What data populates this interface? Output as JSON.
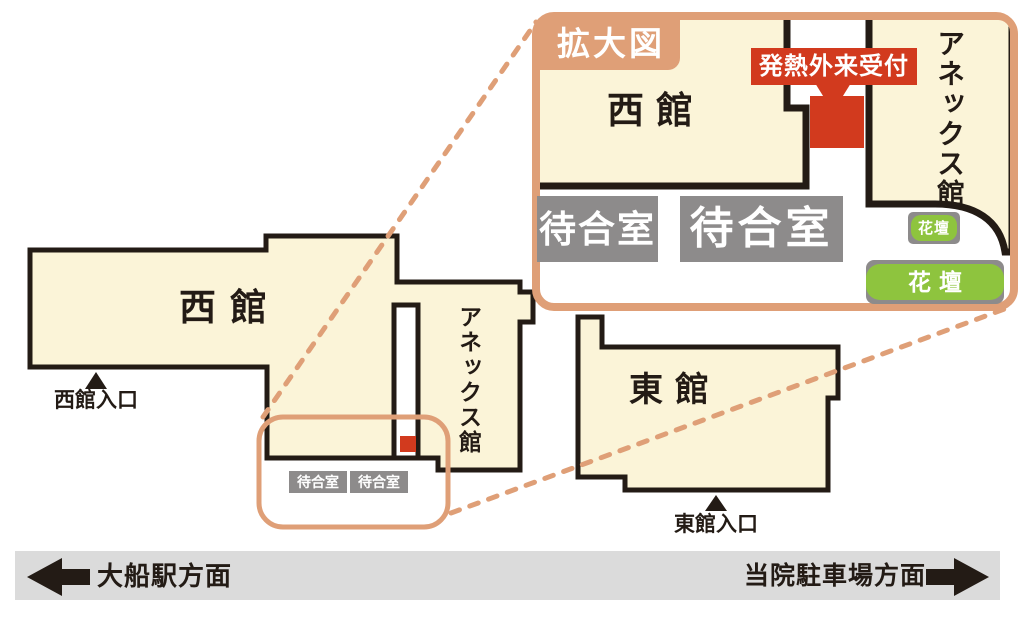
{
  "colors": {
    "cream": "#FBF4D8",
    "salmon": "#DF9F77",
    "red": "#D23A1E",
    "green": "#8EC43E",
    "gray": "#8D8B8B",
    "bar": "#DBDBDB",
    "outline": "#231B15",
    "white": "#FFFFFF"
  },
  "inset": {
    "title": "拡大図",
    "west_label": "西館",
    "annex_label": "アネックス館",
    "fever_label": "発熱外来受付",
    "waiting_rooms": [
      "待合室",
      "待合室"
    ],
    "flowerbed_small": "花壇",
    "flowerbed_large": "花壇"
  },
  "map": {
    "west_label": "西館",
    "annex_label": "アネックス館",
    "east_label": "東館",
    "west_entrance": "西館入口",
    "east_entrance": "東館入口",
    "waiting_rooms": [
      "待合室",
      "待合室"
    ]
  },
  "footer": {
    "left": "大船駅方面",
    "right": "当院駐車場方面"
  }
}
